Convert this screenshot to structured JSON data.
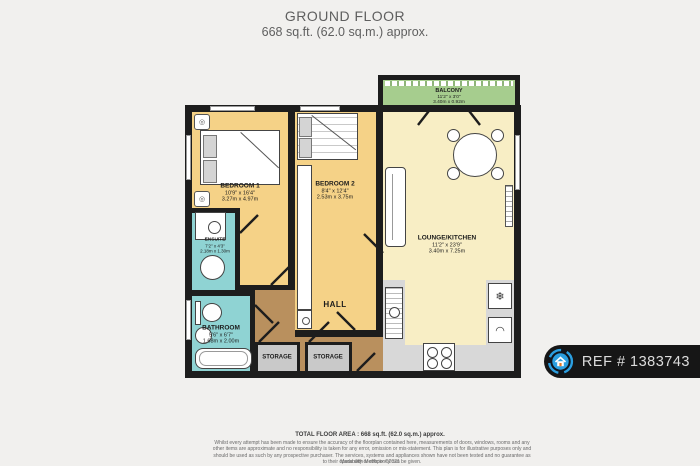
{
  "header": {
    "title": "GROUND FLOOR",
    "subtitle": "668 sq.ft. (62.0 sq.m.) approx."
  },
  "rooms": {
    "balcony": {
      "name": "BALCONY",
      "imperial": "11'2\" x 3'0\"",
      "metric": "3.40m x 0.92m"
    },
    "bedroom1": {
      "name": "BEDROOM 1",
      "imperial": "10'9\" x 16'4\"",
      "metric": "3.27m x 4.97m"
    },
    "bedroom2": {
      "name": "BEDROOM 2",
      "imperial": "8'4\" x 12'4\"",
      "metric": "2.53m x 3.75m"
    },
    "lounge": {
      "name": "LOUNGE/KITCHEN",
      "imperial": "11'2\" x 23'9\"",
      "metric": "3.40m x 7.25m"
    },
    "ensuite": {
      "name": "ENSUITE",
      "imperial": "7'2\" x 4'3\"",
      "metric": "2.18m x 1.30m"
    },
    "bathroom": {
      "name": "BATHROOM",
      "imperial": "5'6\" x 6'7\"",
      "metric": "1.68m x 2.00m"
    },
    "hall": {
      "name": "HALL"
    },
    "storage1": {
      "name": "STORAGE"
    },
    "storage2": {
      "name": "STORAGE"
    }
  },
  "icons": {
    "freezer": "❄"
  },
  "footer": {
    "total": "TOTAL FLOOR AREA : 668 sq.ft. (62.0 sq.m.) approx.",
    "disclaimer": "Whilst every attempt has been made to ensure the accuracy of the floorplan contained here, measurements of doors, windows, rooms and any other items are approximate and no responsibility is taken for any error, omission or mis-statement. This plan is for illustrative purposes only and should be used as such by any prospective purchaser. The services, systems and appliances shown have not been tested and no guarantee as to their operability or efficiency can be given.",
    "credit": "Made with Metropix ©2021"
  },
  "badge": {
    "ref": "REF # 1383743"
  },
  "colors": {
    "wall": "#1d1d1d",
    "bedroom": "#f5d287",
    "lounge": "#f8eec5",
    "wet_room": "#8fd3d3",
    "hall": "#b9905e",
    "balcony": "#a6cd8e",
    "storage": "#c9c9c9",
    "badge_blue": "#2b9fe0",
    "background": "#f1f0ee"
  }
}
